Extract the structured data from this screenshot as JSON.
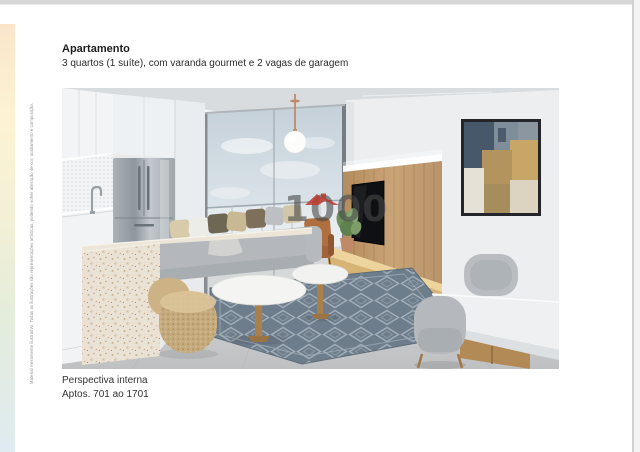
{
  "header": {
    "title": "Apartamento",
    "subtitle": "3 quartos (1 suíte), com varanda gourmet e 2 vagas de garagem"
  },
  "caption": {
    "line1": "Perspectiva interna",
    "line2": "Aptos. 701 ao 1701"
  },
  "watermark": {
    "text": "1000",
    "roof_icon": "house-roof-icon",
    "roof_color": "#bf3a2e",
    "text_color": "rgba(70,72,74,0.6)"
  },
  "disclaimer": "Material meramente ilustrativo. Todas as ilustrações são representações artísticas, podendo sofrer alteração de cor, acabamento e composição.",
  "accent_strip": {
    "gradient_colors": [
      "#fae5cb",
      "#fdf3d4",
      "#f3f0d6",
      "#e4eddb",
      "#dfebf1"
    ]
  },
  "page_chrome": {
    "top_bar_color": "#d7d7d7",
    "right_edge_color": "#d2d2d2"
  }
}
